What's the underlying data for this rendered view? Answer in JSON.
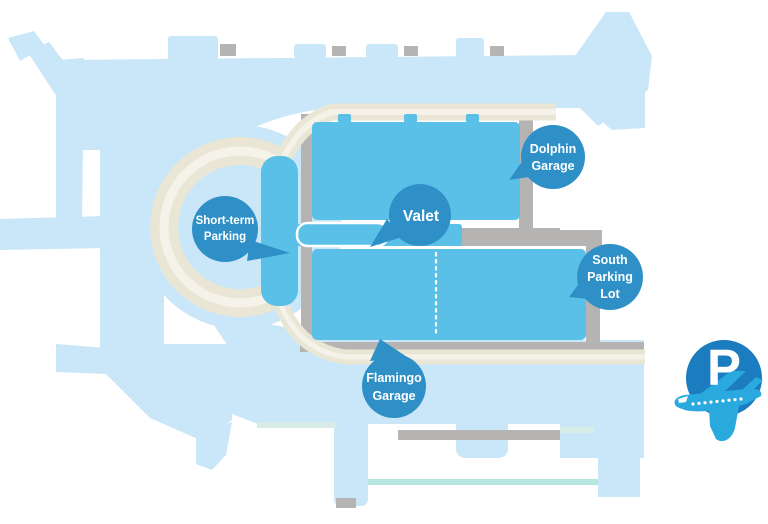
{
  "map": {
    "colors": {
      "grounds": "#c9e7f8",
      "road_gray": "#b5b4b3",
      "road_beige": "#e9e6d6",
      "road_beige_light": "#f5f3e9",
      "structure_blue": "#5bc0e8",
      "marker_blue": "#2e90c7",
      "label_text": "#ffffff",
      "teal_line": "#b7e6e1",
      "mint_line": "#d8ece7",
      "logo_circle": "#1b7dbf",
      "logo_plane": "#2aa9de"
    },
    "markers": {
      "short_term_parking": {
        "lines": [
          "Short-term",
          "Parking"
        ]
      },
      "valet": {
        "lines": [
          "Valet"
        ]
      },
      "dolphin_garage": {
        "lines": [
          "Dolphin",
          "Garage"
        ]
      },
      "south_parking_lot": {
        "lines": [
          "South",
          "Parking",
          "Lot"
        ]
      },
      "flamingo_garage": {
        "lines": [
          "Flamingo",
          "Garage"
        ]
      }
    },
    "logo": {
      "letter": "P",
      "icon": "airplane-icon"
    }
  }
}
